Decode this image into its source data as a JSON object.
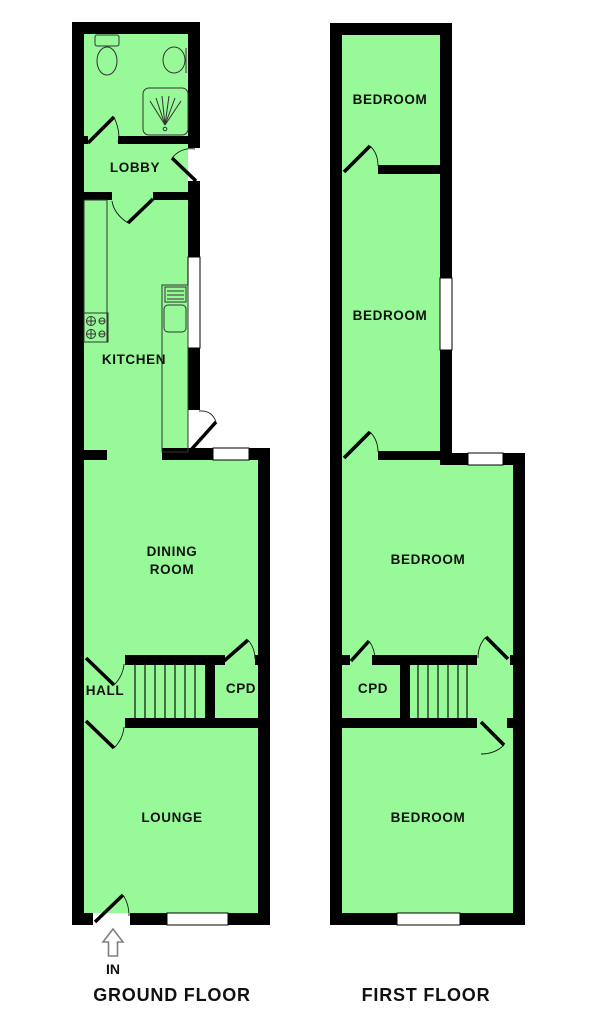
{
  "colors": {
    "room_fill": "#97f997",
    "wall": "#000000",
    "window_fill": "#ffffff",
    "bg": "#ffffff"
  },
  "ground_floor": {
    "title": "GROUND FLOOR",
    "entrance_label": "IN",
    "rooms": {
      "lobby": "LOBBY",
      "kitchen": "KITCHEN",
      "dining_room_line1": "DINING",
      "dining_room_line2": "ROOM",
      "hall": "HALL",
      "cupboard": "CPD",
      "lounge": "LOUNGE"
    },
    "icons": [
      "toilet-icon",
      "basin-icon",
      "shower-icon",
      "hob-icon",
      "sink-drainer-icon",
      "stairs-icon",
      "entrance-up-arrow-icon"
    ]
  },
  "first_floor": {
    "title": "FIRST FLOOR",
    "rooms": {
      "bedroom_front": "BEDROOM",
      "bedroom_middle": "BEDROOM",
      "bedroom_third": "BEDROOM",
      "cupboard": "CPD",
      "bedroom_back": "BEDROOM"
    },
    "icons": [
      "stairs-icon"
    ]
  }
}
